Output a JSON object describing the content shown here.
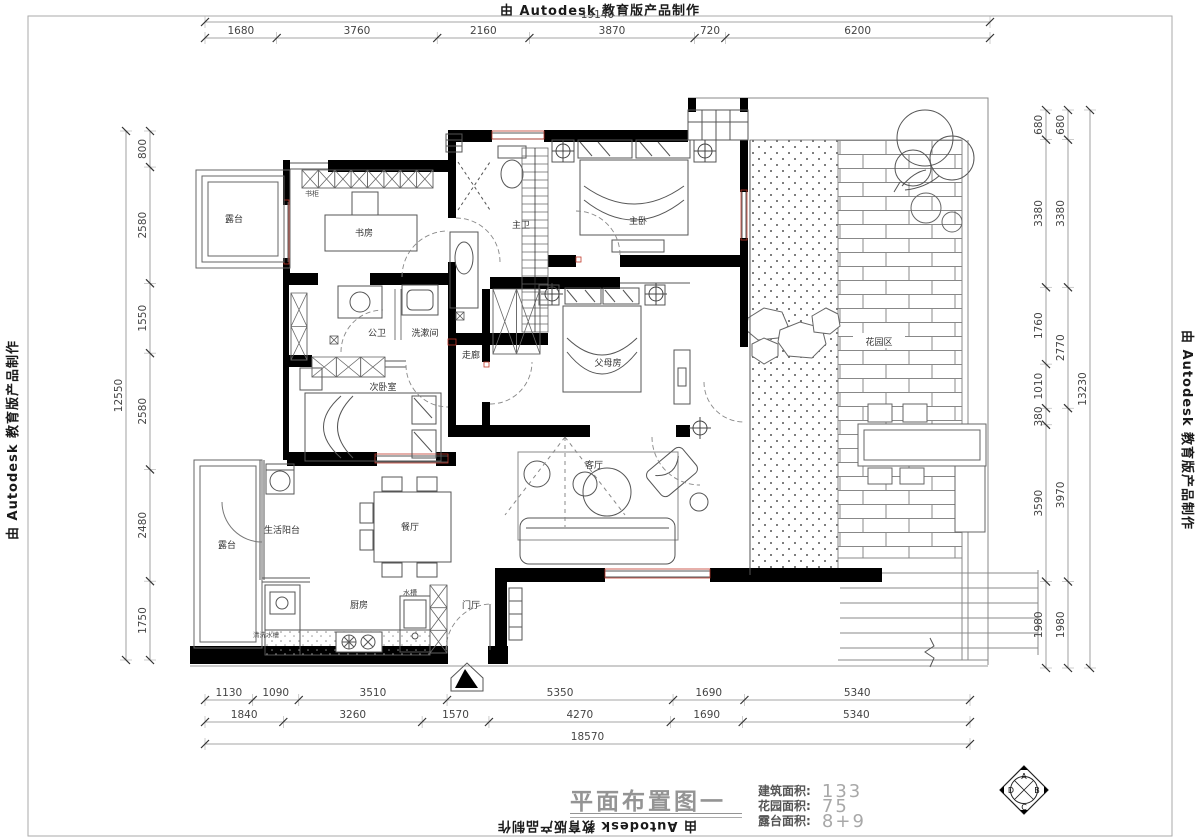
{
  "watermark": {
    "text": "由 Autodesk 教育版产品制作"
  },
  "dimensions": {
    "top": {
      "overall": "19140",
      "segments": [
        "1680",
        "3760",
        "2160",
        "3870",
        "720",
        "6200"
      ]
    },
    "left": {
      "overall": "12550",
      "segments": [
        "800",
        "2580",
        "1550",
        "2580",
        "2480",
        "1750"
      ]
    },
    "right": {
      "overall": "13230",
      "inner_segments": [
        "680",
        "3380",
        "1760",
        "1010",
        "380",
        "3590",
        "1980"
      ],
      "outer_segments": [
        "680",
        "3380",
        "2770",
        "3970",
        "1980"
      ]
    },
    "bottom": {
      "overall": "18570",
      "row1": [
        "1130",
        "1090",
        "3510",
        "5350",
        "1690",
        "5340"
      ],
      "row2": [
        "1840",
        "3260",
        "1570",
        "4270",
        "1690",
        "5340"
      ]
    }
  },
  "rooms": {
    "terrace_top": "露台",
    "study": "书房",
    "bookcase": "书柜",
    "master_bath": "主卫",
    "master_bedroom": "主卧",
    "public_bath": "公卫",
    "washroom": "洗漱间",
    "corridor": "走廊",
    "second_bedroom": "次卧室",
    "parents_room": "父母房",
    "garden": "花园区",
    "living_room": "客厅",
    "dining_room": "餐厅",
    "service_balcony": "生活阳台",
    "terrace_bottom": "露台",
    "kitchen": "厨房",
    "sink": "水槽",
    "entry": "门厅",
    "wash_counter": "清洗水槽"
  },
  "title_block": {
    "title": "平面布置图一",
    "areas": [
      {
        "label": "建筑面积:",
        "value": "133"
      },
      {
        "label": "花园面积:",
        "value": "75"
      },
      {
        "label": "露台面积:",
        "value": "8+9"
      }
    ]
  },
  "logo": {
    "letters": [
      "A",
      "B",
      "C",
      "D"
    ]
  }
}
